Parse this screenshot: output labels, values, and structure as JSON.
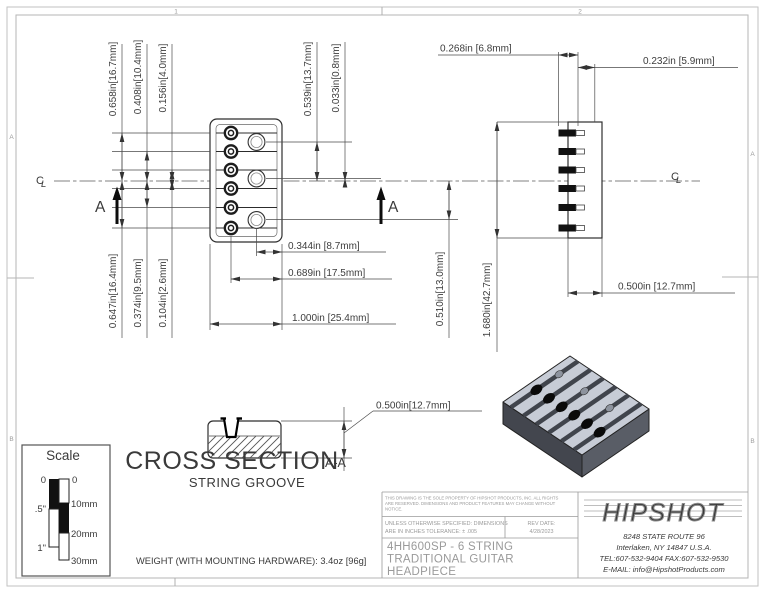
{
  "sheet": {
    "zones": {
      "top": [
        "1",
        "2"
      ],
      "left": [
        "A",
        "B"
      ],
      "right": [
        "A",
        "B"
      ]
    }
  },
  "front_view": {
    "dims": {
      "s1": "0.658in[16.7mm]",
      "s2": "0.408in[10.4mm]",
      "s3": "0.156in[4.0mm]",
      "hole_top": "0.539in[13.7mm]",
      "hole_mid": "0.033in[0.8mm]",
      "s6": "0.647in[16.4mm]",
      "s5": "0.374in[9.5mm]",
      "s4": "0.104in[2.6mm]",
      "hole_edge": "0.344in [8.7mm]",
      "hole_screw": "0.689in [17.5mm]",
      "width": "1.000in [25.4mm]",
      "hole_bottom": "0.510in[13.0mm]",
      "length": "1.680in[42.7mm]"
    },
    "section_marker": "A"
  },
  "side_view": {
    "dims": {
      "pin_inset": "0.268in [6.8mm]",
      "pin_tip": "0.232in [5.9mm]",
      "depth": "0.500in [12.7mm]"
    }
  },
  "cross_section": {
    "title": "CROSS SECTION",
    "section_ref": "A-A",
    "subtitle": "STRING GROOVE",
    "height": "0.500in[12.7mm]"
  },
  "scale_widget": {
    "title": "Scale",
    "inch_ticks": [
      "0",
      ".5\"",
      "1\""
    ],
    "mm_ticks": [
      "0",
      "10mm",
      "20mm",
      "30mm"
    ]
  },
  "notes": {
    "weight": "WEIGHT (WITH MOUNTING HARDWARE): 3.4oz [96g]"
  },
  "title_block": {
    "notice_lines": [
      "THIS DRAWING IS THE SOLE PROPERTY OF HIPSHOT PRODUCTS, INC. ALL RIGHTS",
      "ARE RESERVED. DIMENSIONS AND PRODUCT FEATURES MAY CHANGE WITHOUT",
      "NOTICE."
    ],
    "tolerance_lines": [
      "UNLESS OTHERWISE SPECIFIED: DIMENSIONS",
      "ARE IN INCHES TOLERANCE: ± .005"
    ],
    "rev_date_label": "REV DATE:",
    "rev_date": "4/28/2023",
    "part_title_lines": [
      "4HH600SP - 6 STRING",
      "TRADITIONAL GUITAR",
      "HEADPIECE"
    ]
  },
  "company": {
    "logo": "HIPSHOT",
    "address_line1": "8248 STATE ROUTE 96",
    "address_line2": "Interlaken, NY 14847 U.S.A.",
    "address_line3": "TEL:607-532-9404 FAX:607-532-9530",
    "address_line4": "E-MAIL: info@HipshotProducts.com"
  },
  "symbols": {
    "centerline_c": "C",
    "centerline_l": "L"
  },
  "colors": {
    "line": "#3a3a3a",
    "border": "#bcbcbc",
    "muted_text": "#9a9a9a",
    "body_top": "#c7ccd6",
    "body_front": "#43464e",
    "body_side": "#595d66"
  }
}
